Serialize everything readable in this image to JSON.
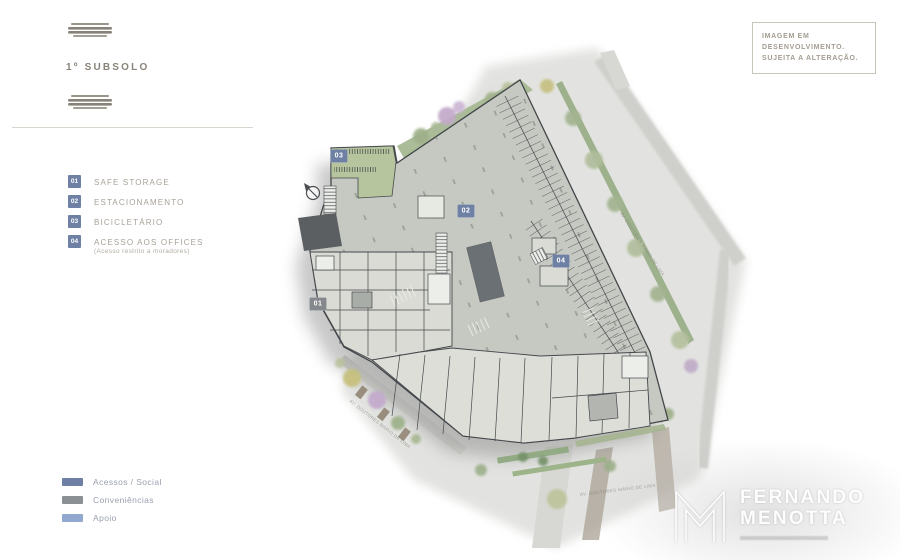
{
  "header": {
    "title": "1º SUBSOLO",
    "notice": {
      "line1": "IMAGEM EM",
      "line2": "DESENVOLVIMENTO.",
      "line3": "SUJEITA A ALTERAÇÃO."
    }
  },
  "legend": {
    "items": [
      {
        "num": "01",
        "label": "SAFE STORAGE",
        "sublabel": "",
        "badge_color": "#6e81a4"
      },
      {
        "num": "02",
        "label": "ESTACIONAMENTO",
        "sublabel": "",
        "badge_color": "#6e81a4"
      },
      {
        "num": "03",
        "label": "BICICLETÁRIO",
        "sublabel": "",
        "badge_color": "#6e81a4"
      },
      {
        "num": "04",
        "label": "ACESSO AOS OFFICES",
        "sublabel": "(Acesso restrito a moradores)",
        "badge_color": "#6e81a4"
      }
    ]
  },
  "category_legend": {
    "items": [
      {
        "label": "Acessos / Social",
        "color": "#6e81a4"
      },
      {
        "label": "Conveniências",
        "color": "#8b9094"
      },
      {
        "label": "Apoio",
        "color": "#93a8cf"
      }
    ]
  },
  "plan": {
    "markers": [
      {
        "num": "01",
        "x": 318,
        "y": 304,
        "color": "#84888c"
      },
      {
        "num": "02",
        "x": 466,
        "y": 211,
        "color": "#6e81a4"
      },
      {
        "num": "03",
        "x": 339,
        "y": 156,
        "color": "#6e81a4"
      },
      {
        "num": "04",
        "x": 561,
        "y": 261,
        "color": "#6e81a4"
      }
    ],
    "street_labels": [
      {
        "text": "AV. DOUTORES MÁRIO DE LIMA",
        "x": 350,
        "y": 398,
        "rot": 38
      },
      {
        "text": "AV. DOUTORES MÁRIO DE LIMA",
        "x": 580,
        "y": 492,
        "rot": -7
      },
      {
        "text": "AV. DOUTORES MÁRIO DE LIMA",
        "x": 621,
        "y": 210,
        "rot": 56
      }
    ],
    "colors": {
      "building_floor": "#c6c9c1",
      "rooms": "#dcded7",
      "core": "#6b7074",
      "ramp": "#5c5f61",
      "green": "#a7b893",
      "ground": "#e2e3e0"
    }
  },
  "watermark": {
    "line1": "FERNANDO",
    "line2": "MENOTTA"
  }
}
